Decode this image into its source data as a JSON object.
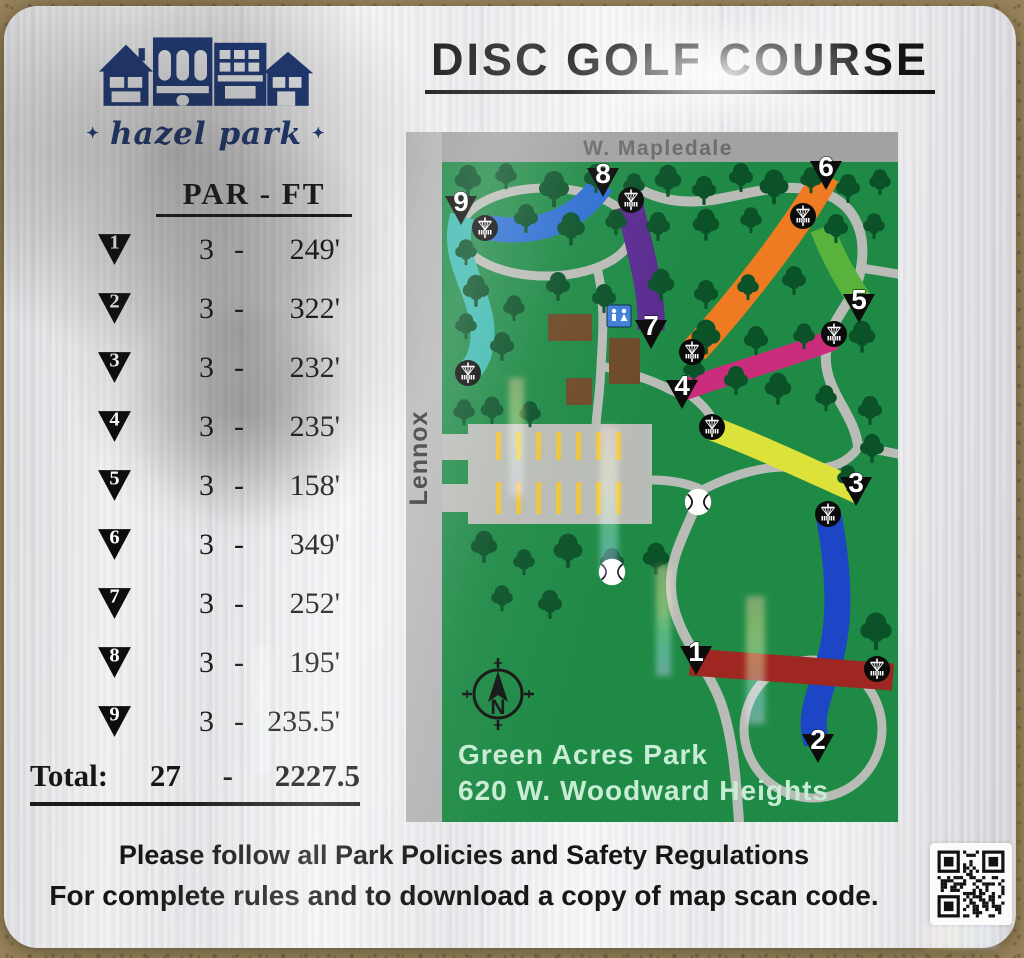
{
  "sign": {
    "title": "DISC GOLF COURSE",
    "logo": {
      "script_name": "hazel park",
      "star": "✦"
    },
    "table": {
      "header": "PAR - FT",
      "sep": "-",
      "holes": [
        {
          "num": "1",
          "par": "3",
          "dist": "249'"
        },
        {
          "num": "2",
          "par": "3",
          "dist": "322'"
        },
        {
          "num": "3",
          "par": "3",
          "dist": "232'"
        },
        {
          "num": "4",
          "par": "3",
          "dist": "235'"
        },
        {
          "num": "5",
          "par": "3",
          "dist": "158'"
        },
        {
          "num": "6",
          "par": "3",
          "dist": "349'"
        },
        {
          "num": "7",
          "par": "3",
          "dist": "252'"
        },
        {
          "num": "8",
          "par": "3",
          "dist": "195'"
        },
        {
          "num": "9",
          "par": "3",
          "dist": "235.5'"
        }
      ],
      "total": {
        "label": "Total:",
        "par": "27",
        "dist": "2227.5"
      }
    },
    "footer": {
      "line1": "Please follow all Park Policies and Safety Regulations",
      "line2": "For complete rules and to download a copy of map scan code."
    }
  },
  "map": {
    "streets": {
      "top": "W. Mapledale",
      "left": "Lennox"
    },
    "park_name": "Green Acres Park",
    "address": "620 W. Woodward Heights",
    "compass_label": "N",
    "holes": [
      {
        "num": "1",
        "color": "#9e2721"
      },
      {
        "num": "2",
        "color": "#1c46c6"
      },
      {
        "num": "3",
        "color": "#dde23a"
      },
      {
        "num": "4",
        "color": "#c92d7c"
      },
      {
        "num": "5",
        "color": "#58b23c"
      },
      {
        "num": "6",
        "color": "#ee7a21"
      },
      {
        "num": "7",
        "color": "#5a2b90"
      },
      {
        "num": "8",
        "color": "#2e6fd2"
      },
      {
        "num": "9",
        "color": "#3fbab0"
      }
    ]
  },
  "colors": {
    "field_green": "#1f8a46",
    "tree_green": "#0b5229",
    "path_gray": "#b9bcb6",
    "street_top_gray": "#a2a2a2",
    "street_left_gray": "#b5b5b6",
    "street_text_gray": "#6b6b6b",
    "parking_stripe_yellow": "#eec43c",
    "building_brown": "#6d4a28",
    "restroom_blue": "#3f7fd6",
    "logo_navy": "#1e3a78",
    "mint_text": "#c8ecd4"
  }
}
